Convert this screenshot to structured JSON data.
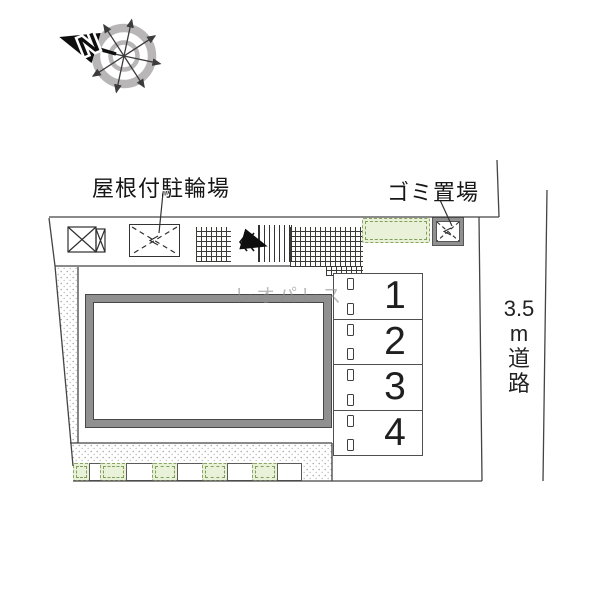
{
  "compass": {
    "north_label": "N"
  },
  "labels": {
    "bicycle_parking": "屋根付駐輪場",
    "garbage_area": "ゴミ置場",
    "road_lines": [
      "3.5",
      "m",
      "道",
      "路"
    ],
    "road_full": "3.5m道路"
  },
  "parking": {
    "spaces": [
      {
        "label": "1"
      },
      {
        "label": "2"
      },
      {
        "label": "3"
      },
      {
        "label": "4"
      }
    ]
  },
  "watermark": {
    "text": "レオパレス"
  },
  "colors": {
    "line": "#444444",
    "wall_gray": "#909090",
    "planter_green_fill": "#e9f1d9",
    "planter_green_border": "#8aa463",
    "compass_ring": "#b8b6b6"
  }
}
